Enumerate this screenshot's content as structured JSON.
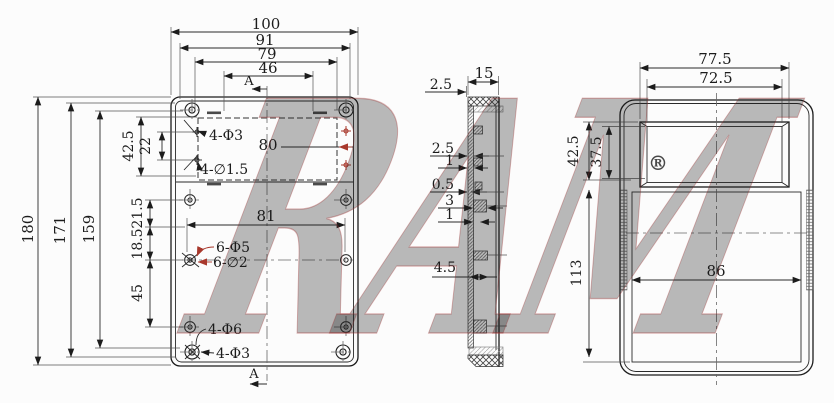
{
  "drawing": {
    "front_view": {
      "dims": {
        "overall_width": "100",
        "outer_width": "91",
        "inner_width": "79",
        "slot_width": "46",
        "overall_height": "180",
        "outer_height": "171",
        "inner_height": "159",
        "recess_height": "42.5",
        "hole_gap": "22",
        "top_gap": "21.5",
        "mid_gap": "18.5",
        "bottom_gap": "45",
        "recess_width": "80",
        "hole_span": "81"
      },
      "labels": {
        "top_holes": "4-Φ3",
        "small_holes": "4-∅1.5",
        "mid_holes_large": "6-Φ5",
        "mid_holes_small": "6-∅2",
        "bottom_holes": "4-Φ6",
        "corner_holes": "4-Φ3"
      },
      "section_marker": "A"
    },
    "section_view": {
      "dims": {
        "thickness": "15",
        "top_wall": "2.5",
        "wall_a": "2.5",
        "wall_b": "1",
        "wall_c": "0.5",
        "boss_a": "3",
        "boss_b": "1",
        "boss_c": "4.5"
      }
    },
    "side_view": {
      "dims": {
        "window_outer_width": "77.5",
        "window_inner_width": "72.5",
        "window_outer_height": "42.5",
        "window_inner_height": "37.5",
        "body_height": "113",
        "inner_width": "86"
      }
    },
    "watermark": {
      "text": "RAM",
      "symbol": "®",
      "color": "#c24848"
    }
  },
  "colors": {
    "line": "#1c1c1c",
    "accent_red": "#a8382c",
    "background": "#fcfcfc"
  }
}
